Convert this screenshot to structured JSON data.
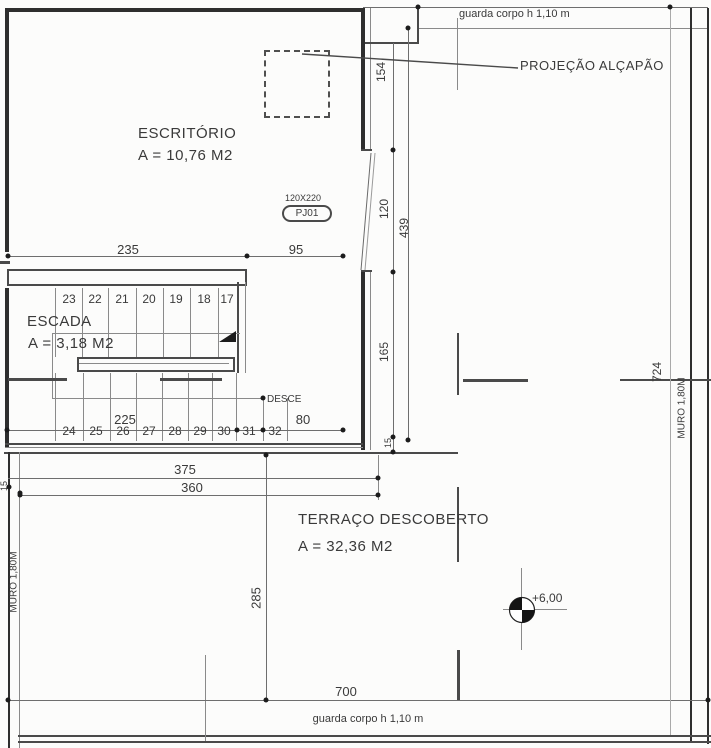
{
  "colors": {
    "bg": "#fcfcfb",
    "line": "#4a4a4a",
    "wall": "#2e2e2e",
    "dim": "#6e6e6e",
    "text": "#3a3a3a"
  },
  "rooms": {
    "escritorio": {
      "name": "ESCRITÓRIO",
      "area": "A = 10,76 M2"
    },
    "escada": {
      "name": "ESCADA",
      "area": "A = 3,18 M2"
    },
    "terraco": {
      "name": "TERRAÇO DESCOBERTO",
      "area": "A = 32,36 M2"
    }
  },
  "stairs": {
    "upper_numbers": [
      "23",
      "22",
      "21",
      "20",
      "19",
      "18",
      "17"
    ],
    "lower_numbers": [
      "24",
      "25",
      "26",
      "27",
      "28",
      "29",
      "30",
      "31",
      "32"
    ]
  },
  "dims": {
    "w235": "235",
    "w95": "95",
    "w225": "225",
    "w80": "80",
    "w375": "375",
    "w360": "360",
    "w700": "700",
    "h154": "154",
    "h120": "120",
    "h439": "439",
    "h165": "165",
    "h285": "285",
    "h724": "724",
    "t15_left": "15",
    "t15_right": "15"
  },
  "annotations": {
    "guard_rail_top": "guarda corpo h 1,10 m",
    "guard_rail_bottom": "guarda corpo h 1,10 m",
    "hatch_projection": "PROJEÇÃO ALÇAPÃO",
    "descend": "DESCE",
    "wall_left": "MURO 1,80M",
    "wall_right": "MURO 1,80M",
    "level_mark": "+6,00",
    "door_tag": {
      "size": "120X220",
      "code": "PJ01"
    }
  }
}
